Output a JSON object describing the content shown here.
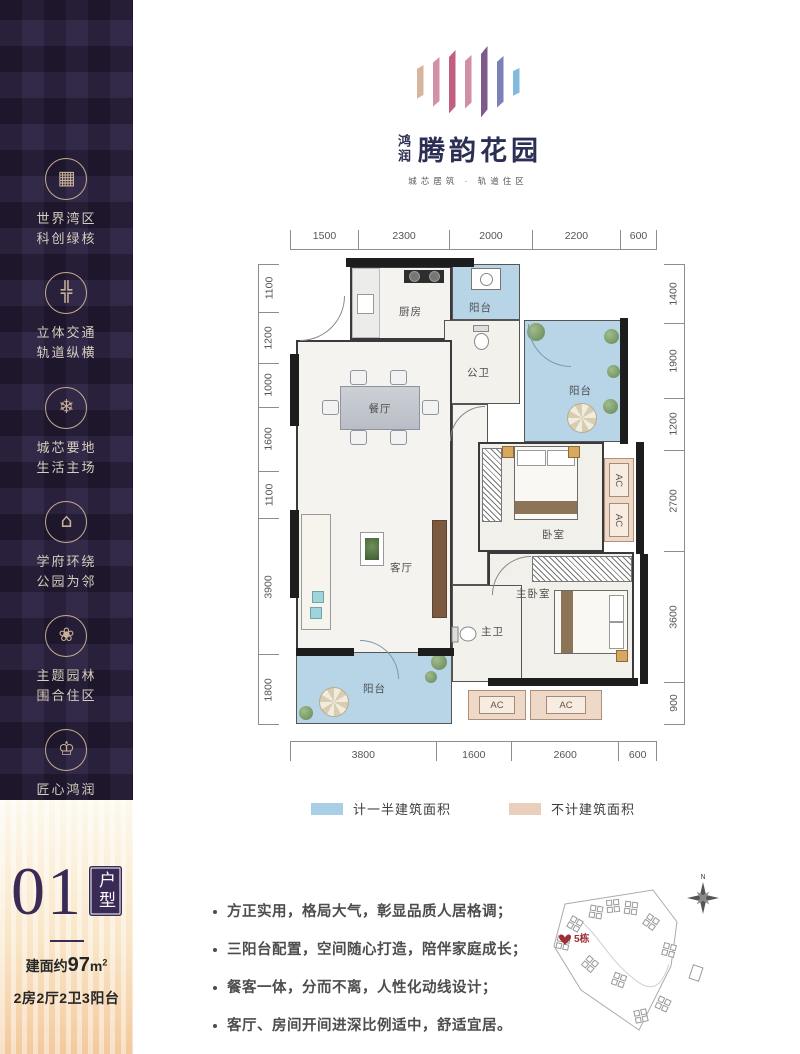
{
  "brand": {
    "name_small": "鸿润",
    "name_large": "腾韵花园",
    "tagline": "城芯居筑 · 轨道住区",
    "bars": [
      {
        "color": "#d7b49e",
        "h": 34
      },
      {
        "color": "#d291a8",
        "h": 50
      },
      {
        "color": "#c25f7e",
        "h": 64
      },
      {
        "color": "#cf8fa4",
        "h": 54
      },
      {
        "color": "#7c5a8c",
        "h": 72
      },
      {
        "color": "#7b80b6",
        "h": 52
      },
      {
        "color": "#82bade",
        "h": 28
      }
    ]
  },
  "sidebar": {
    "items": [
      {
        "icon": "building-icon",
        "line1": "世界湾区",
        "line2": "科创绿核"
      },
      {
        "icon": "transit-cross-icon",
        "line1": "立体交通",
        "line2": "轨道纵横"
      },
      {
        "icon": "snowflake-icon",
        "line1": "城芯要地",
        "line2": "生活主场"
      },
      {
        "icon": "school-icon",
        "line1": "学府环绕",
        "line2": "公园为邻"
      },
      {
        "icon": "flower-icon",
        "line1": "主题园林",
        "line2": "围合住区"
      },
      {
        "icon": "crown-icon",
        "line1": "匠心鸿润",
        "line2": "封疆上著"
      }
    ]
  },
  "floorplan": {
    "dims_top": [
      1500,
      2300,
      2000,
      2200,
      600
    ],
    "dims_bottom": [
      3800,
      1600,
      2600,
      600
    ],
    "dims_left": [
      1100,
      1200,
      1000,
      1600,
      1100,
      3900,
      1800
    ],
    "dims_right": [
      1400,
      1900,
      1200,
      2700,
      3600,
      900
    ],
    "rooms": {
      "kitchen": "厨房",
      "dining": "餐厅",
      "living": "客厅",
      "balcony": "阳台",
      "guest_bath": "公卫",
      "master_bath": "主卫",
      "bedroom": "卧室",
      "master_bedroom": "主卧室"
    },
    "ac_label": "AC"
  },
  "legend": {
    "items": [
      {
        "color": "#a9cfe7",
        "label": "计一半建筑面积"
      },
      {
        "color": "#e9cfbc",
        "label": "不计建筑面积"
      }
    ]
  },
  "unit": {
    "number": "01",
    "type_label": "户型",
    "area_prefix": "建面约",
    "area_value": "97",
    "area_unit": "m",
    "area_sup": "2",
    "layout": "2房2厅2卫3阳台"
  },
  "features": [
    "方正实用，格局大气，彰显品质人居格调；",
    "三阳台配置，空间随心打造，陪伴家庭成长；",
    "餐客一体，分而不离，人性化动线设计；",
    "客厅、房间开间进深比例适中，舒适宜居。"
  ],
  "siteplan": {
    "marker": "5栋",
    "compass_n": "N"
  }
}
